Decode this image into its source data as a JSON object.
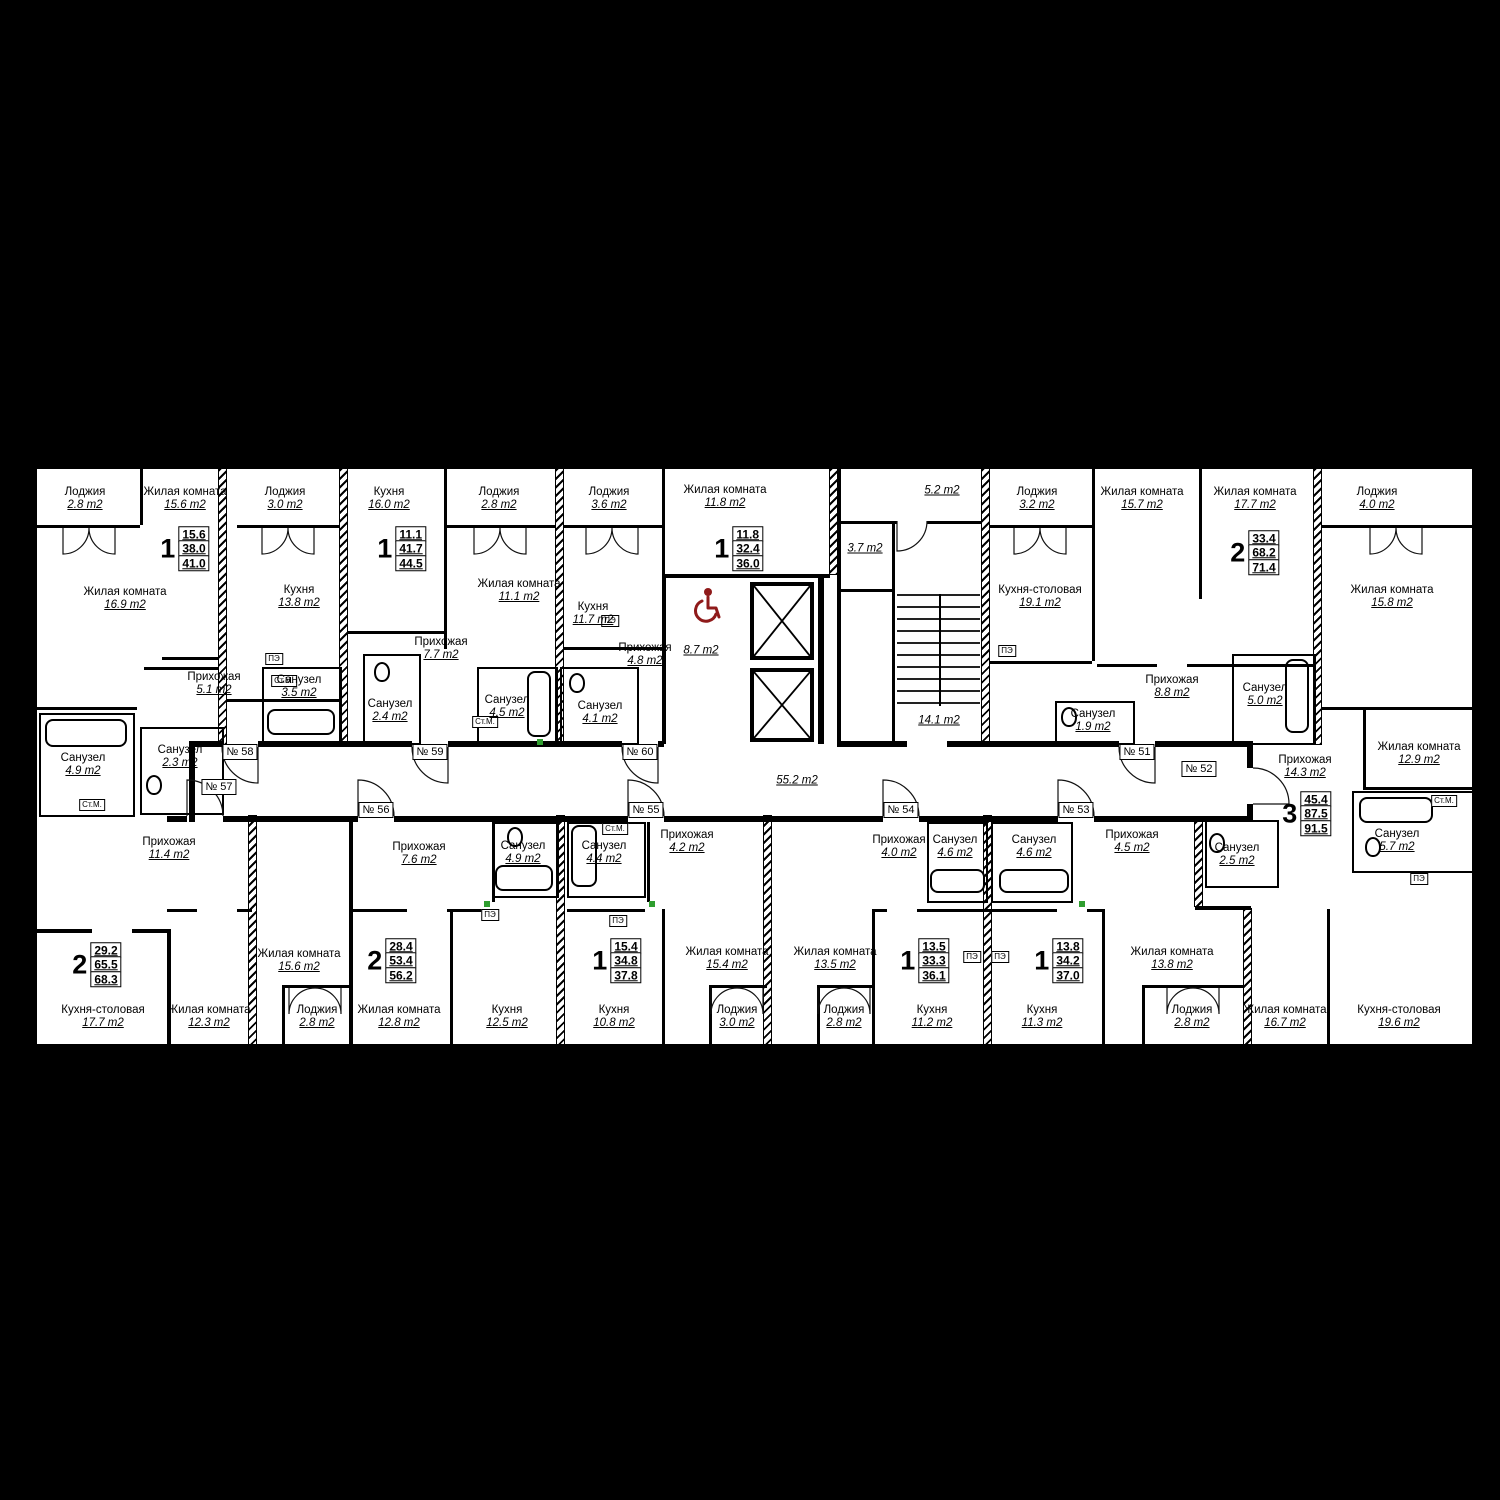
{
  "colors": {
    "wall": "#000000",
    "paper": "#ffffff",
    "accent_red": "#8f1a1a",
    "appliance_text": "#000000",
    "vent_green": "#2f9e2f"
  },
  "appliance_labels": {
    "stove": "ПЭ",
    "washer": "Ст.М."
  },
  "common": {
    "vestibule": "5.2 m2",
    "lobby": "3.7 m2",
    "stairwell": "14.1 m2",
    "wheelchair_lobby": "8.7 m2",
    "corridor": "55.2 m2"
  },
  "apartments": [
    {
      "tag": "№ 51",
      "rooms": "2",
      "living_area": "33.4",
      "area": "68.2",
      "total_area": "71.4"
    },
    {
      "tag": "№ 52",
      "rooms": "3",
      "living_area": "45.4",
      "area": "87.5",
      "total_area": "91.5"
    },
    {
      "tag": "№ 53",
      "rooms": "1",
      "living_area": "13.8",
      "area": "34.2",
      "total_area": "37.0"
    },
    {
      "tag": "№ 54",
      "rooms": "1",
      "living_area": "13.5",
      "area": "33.3",
      "total_area": "36.1"
    },
    {
      "tag": "№ 55",
      "rooms": "1",
      "living_area": "15.4",
      "area": "34.8",
      "total_area": "37.8"
    },
    {
      "tag": "№ 56",
      "rooms": "2",
      "living_area": "28.4",
      "area": "53.4",
      "total_area": "56.2"
    },
    {
      "tag": "№ 57",
      "rooms": "2",
      "living_area": "29.2",
      "area": "65.5",
      "total_area": "68.3"
    },
    {
      "tag": "№ 58",
      "rooms": "1",
      "living_area": "15.6",
      "area": "38.0",
      "total_area": "41.0"
    },
    {
      "tag": "№ 59",
      "rooms": "1",
      "living_area": "11.1",
      "area": "41.7",
      "total_area": "44.5"
    },
    {
      "tag": "№ 60",
      "rooms": "1",
      "living_area": "11.8",
      "area": "32.4",
      "total_area": "36.0"
    }
  ],
  "rooms": [
    {
      "name": "Лоджия",
      "area": "2.8 m2"
    },
    {
      "name": "Жилая комната",
      "area": "16.9 m2"
    },
    {
      "name": "Жилая комната",
      "area": "15.6 m2"
    },
    {
      "name": "Лоджия",
      "area": "3.0 m2"
    },
    {
      "name": "Кухня",
      "area": "13.8 m2"
    },
    {
      "name": "Кухня",
      "area": "16.0 m2"
    },
    {
      "name": "Лоджия",
      "area": "2.8 m2"
    },
    {
      "name": "Жилая комната",
      "area": "11.1 m2"
    },
    {
      "name": "Лоджия",
      "area": "3.6 m2"
    },
    {
      "name": "Кухня",
      "area": "11.7 m2"
    },
    {
      "name": "Жилая комната",
      "area": "11.8 m2"
    },
    {
      "name": "Лоджия",
      "area": "3.2 m2"
    },
    {
      "name": "Жилая комната",
      "area": "15.7 m2"
    },
    {
      "name": "Жилая комната",
      "area": "17.7 m2"
    },
    {
      "name": "Лоджия",
      "area": "4.0 m2"
    },
    {
      "name": "Кухня-столовая",
      "area": "19.1 m2"
    },
    {
      "name": "Жилая комната",
      "area": "15.8 m2"
    },
    {
      "name": "Прихожая",
      "area": "5.1 m2"
    },
    {
      "name": "Санузел",
      "area": "3.5 m2"
    },
    {
      "name": "Санузел",
      "area": "2.4 m2"
    },
    {
      "name": "Прихожая",
      "area": "7.7 m2"
    },
    {
      "name": "Санузел",
      "area": "4.5 m2"
    },
    {
      "name": "Прихожая",
      "area": "4.8 m2"
    },
    {
      "name": "Санузел",
      "area": "4.1 m2"
    },
    {
      "name": "Прихожая",
      "area": "8.8 m2"
    },
    {
      "name": "Санузел",
      "area": "1.9 m2"
    },
    {
      "name": "Санузел",
      "area": "5.0 m2"
    },
    {
      "name": "Санузел",
      "area": "4.9 m2"
    },
    {
      "name": "Санузел",
      "area": "2.3 m2"
    },
    {
      "name": "Прихожая",
      "area": "11.4 m2"
    },
    {
      "name": "Прихожая",
      "area": "7.6 m2"
    },
    {
      "name": "Санузел",
      "area": "4.9 m2"
    },
    {
      "name": "Санузел",
      "area": "4.4 m2"
    },
    {
      "name": "Прихожая",
      "area": "4.2 m2"
    },
    {
      "name": "Прихожая",
      "area": "4.0 m2"
    },
    {
      "name": "Санузел",
      "area": "4.6 m2"
    },
    {
      "name": "Санузел",
      "area": "4.6 m2"
    },
    {
      "name": "Прихожая",
      "area": "4.5 m2"
    },
    {
      "name": "Прихожая",
      "area": "14.3 m2"
    },
    {
      "name": "Санузел",
      "area": "2.5 m2"
    },
    {
      "name": "Жилая комната",
      "area": "12.9 m2"
    },
    {
      "name": "Санузел",
      "area": "5.7 m2"
    },
    {
      "name": "Кухня-столовая",
      "area": "17.7 m2"
    },
    {
      "name": "Жилая комната",
      "area": "12.3 m2"
    },
    {
      "name": "Жилая комната",
      "area": "15.6 m2"
    },
    {
      "name": "Лоджия",
      "area": "2.8 m2"
    },
    {
      "name": "Жилая комната",
      "area": "12.8 m2"
    },
    {
      "name": "Кухня",
      "area": "12.5 m2"
    },
    {
      "name": "Кухня",
      "area": "10.8 m2"
    },
    {
      "name": "Жилая комната",
      "area": "15.4 m2"
    },
    {
      "name": "Лоджия",
      "area": "3.0 m2"
    },
    {
      "name": "Жилая комната",
      "area": "13.5 m2"
    },
    {
      "name": "Лоджия",
      "area": "2.8 m2"
    },
    {
      "name": "Кухня",
      "area": "11.2 m2"
    },
    {
      "name": "Кухня",
      "area": "11.3 m2"
    },
    {
      "name": "Жилая комната",
      "area": "13.8 m2"
    },
    {
      "name": "Лоджия",
      "area": "2.8 m2"
    },
    {
      "name": "Жилая комната",
      "area": "16.7 m2"
    },
    {
      "name": "Кухня-столовая",
      "area": "19.6 m2"
    }
  ]
}
